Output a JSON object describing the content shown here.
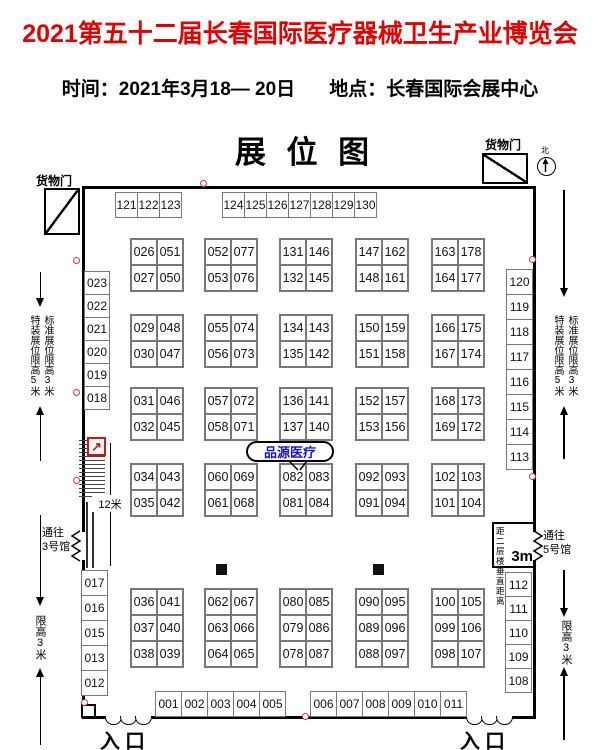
{
  "header": {
    "title": "2021第五十二届长春国际医疗器械卫生产业博览会",
    "title_color": "#e60000",
    "time_label": "时间：",
    "time_value": "2021年3月18— 20日",
    "place_label": "地点：",
    "place_value": "长春国际会展中心"
  },
  "plan": {
    "heading": "展 位 图",
    "north_label": "北",
    "cargo_door_left": "货物门",
    "cargo_door_right": "货物门",
    "entrance_left": "入口",
    "entrance_right": "入口",
    "limit_special": "特装展位限高5米",
    "limit_standard": "标准展位限高3米",
    "limit_height3": "限高3米",
    "passage_hall3": [
      "通往",
      "3号馆"
    ],
    "passage_hall5": [
      "通往",
      "5号馆"
    ],
    "mezzanine_note": "距二层楼垂直距离",
    "mezzanine_value": "3m",
    "stair_length": "12米",
    "callout": {
      "text": "品源医疗",
      "color": "#1414cc"
    },
    "booth_groups": [
      {
        "name": "top-row-a",
        "x": 115,
        "y": 192,
        "dx": 22,
        "dy": 0,
        "w": 23,
        "h": 26,
        "cells": [
          "121",
          "122",
          "123"
        ]
      },
      {
        "name": "top-row-b",
        "x": 222,
        "y": 192,
        "dx": 22,
        "dy": 0,
        "w": 23,
        "h": 26,
        "cells": [
          "124",
          "125",
          "126",
          "127",
          "128",
          "129",
          "130"
        ]
      },
      {
        "name": "left-col-upper",
        "x": 84,
        "y": 271,
        "dx": 0,
        "dy": 23,
        "w": 26,
        "h": 24,
        "cells": [
          "023",
          "022",
          "021",
          "020",
          "019",
          "018"
        ]
      },
      {
        "name": "right-col-upper",
        "x": 506,
        "y": 269,
        "dx": 0,
        "dy": 25,
        "w": 27,
        "h": 26,
        "cells": [
          "120",
          "119",
          "118",
          "117",
          "116",
          "115",
          "114",
          "113"
        ]
      },
      {
        "name": "left-col-lower",
        "x": 81,
        "y": 570,
        "dx": 0,
        "dy": 25,
        "w": 27,
        "h": 26,
        "cells": [
          "017",
          "016",
          "015",
          "013",
          "012"
        ]
      },
      {
        "name": "right-col-lower",
        "x": 505,
        "y": 572,
        "dx": 0,
        "dy": 24,
        "w": 27,
        "h": 25,
        "cells": [
          "112",
          "111",
          "110",
          "109",
          "108"
        ]
      },
      {
        "name": "bottom-row-a",
        "x": 155,
        "y": 691,
        "dx": 26,
        "dy": 0,
        "w": 27,
        "h": 26,
        "cells": [
          "001",
          "002",
          "003",
          "004",
          "005"
        ]
      },
      {
        "name": "bottom-row-b",
        "x": 310,
        "y": 691,
        "dx": 26,
        "dy": 0,
        "w": 27,
        "h": 26,
        "cells": [
          "006",
          "007",
          "008",
          "009",
          "010",
          "011"
        ]
      }
    ],
    "blocks": [
      {
        "x": 130,
        "y": 238,
        "rows": [
          [
            "026",
            "051"
          ],
          [
            "027",
            "050"
          ]
        ]
      },
      {
        "x": 204,
        "y": 238,
        "rows": [
          [
            "052",
            "077"
          ],
          [
            "053",
            "076"
          ]
        ]
      },
      {
        "x": 279,
        "y": 238,
        "rows": [
          [
            "131",
            "146"
          ],
          [
            "132",
            "145"
          ]
        ]
      },
      {
        "x": 355,
        "y": 238,
        "rows": [
          [
            "147",
            "162"
          ],
          [
            "148",
            "161"
          ]
        ]
      },
      {
        "x": 431,
        "y": 238,
        "rows": [
          [
            "163",
            "178"
          ],
          [
            "164",
            "177"
          ]
        ]
      },
      {
        "x": 130,
        "y": 314,
        "rows": [
          [
            "029",
            "048"
          ],
          [
            "030",
            "047"
          ]
        ]
      },
      {
        "x": 204,
        "y": 314,
        "rows": [
          [
            "055",
            "074"
          ],
          [
            "056",
            "073"
          ]
        ]
      },
      {
        "x": 279,
        "y": 314,
        "rows": [
          [
            "134",
            "143"
          ],
          [
            "135",
            "142"
          ]
        ]
      },
      {
        "x": 355,
        "y": 314,
        "rows": [
          [
            "150",
            "159"
          ],
          [
            "151",
            "158"
          ]
        ]
      },
      {
        "x": 431,
        "y": 314,
        "rows": [
          [
            "166",
            "175"
          ],
          [
            "167",
            "174"
          ]
        ]
      },
      {
        "x": 130,
        "y": 387,
        "rows": [
          [
            "031",
            "046"
          ],
          [
            "032",
            "045"
          ]
        ]
      },
      {
        "x": 204,
        "y": 387,
        "rows": [
          [
            "057",
            "072"
          ],
          [
            "058",
            "071"
          ]
        ]
      },
      {
        "x": 279,
        "y": 387,
        "rows": [
          [
            "136",
            "141"
          ],
          [
            "137",
            "140"
          ]
        ]
      },
      {
        "x": 355,
        "y": 387,
        "rows": [
          [
            "152",
            "157"
          ],
          [
            "153",
            "156"
          ]
        ]
      },
      {
        "x": 431,
        "y": 387,
        "rows": [
          [
            "168",
            "173"
          ],
          [
            "169",
            "172"
          ]
        ]
      },
      {
        "x": 130,
        "y": 463,
        "rows": [
          [
            "034",
            "043"
          ],
          [
            "035",
            "042"
          ]
        ]
      },
      {
        "x": 204,
        "y": 463,
        "rows": [
          [
            "060",
            "069"
          ],
          [
            "061",
            "068"
          ]
        ]
      },
      {
        "x": 279,
        "y": 463,
        "rows": [
          [
            "082",
            "083"
          ],
          [
            "081",
            "084"
          ]
        ]
      },
      {
        "x": 355,
        "y": 463,
        "rows": [
          [
            "092",
            "093"
          ],
          [
            "091",
            "094"
          ]
        ]
      },
      {
        "x": 431,
        "y": 463,
        "rows": [
          [
            "102",
            "103"
          ],
          [
            "101",
            "104"
          ]
        ]
      },
      {
        "x": 130,
        "y": 588,
        "rows": [
          [
            "036",
            "041"
          ],
          [
            "037",
            "040"
          ],
          [
            "038",
            "039"
          ]
        ]
      },
      {
        "x": 204,
        "y": 588,
        "rows": [
          [
            "062",
            "067"
          ],
          [
            "063",
            "066"
          ],
          [
            "064",
            "065"
          ]
        ]
      },
      {
        "x": 279,
        "y": 588,
        "rows": [
          [
            "080",
            "085"
          ],
          [
            "079",
            "086"
          ],
          [
            "078",
            "087"
          ]
        ]
      },
      {
        "x": 355,
        "y": 588,
        "rows": [
          [
            "090",
            "095"
          ],
          [
            "089",
            "096"
          ],
          [
            "088",
            "097"
          ]
        ]
      },
      {
        "x": 431,
        "y": 588,
        "rows": [
          [
            "100",
            "105"
          ],
          [
            "099",
            "106"
          ],
          [
            "098",
            "107"
          ]
        ]
      }
    ],
    "red_dots": [
      [
        200,
        180
      ],
      [
        73,
        257
      ],
      [
        73,
        389
      ],
      [
        73,
        477
      ],
      [
        81,
        699
      ],
      [
        302,
        713
      ],
      [
        529,
        256
      ],
      [
        529,
        473
      ]
    ],
    "pillars": [
      [
        216,
        564
      ],
      [
        373,
        564
      ]
    ]
  }
}
